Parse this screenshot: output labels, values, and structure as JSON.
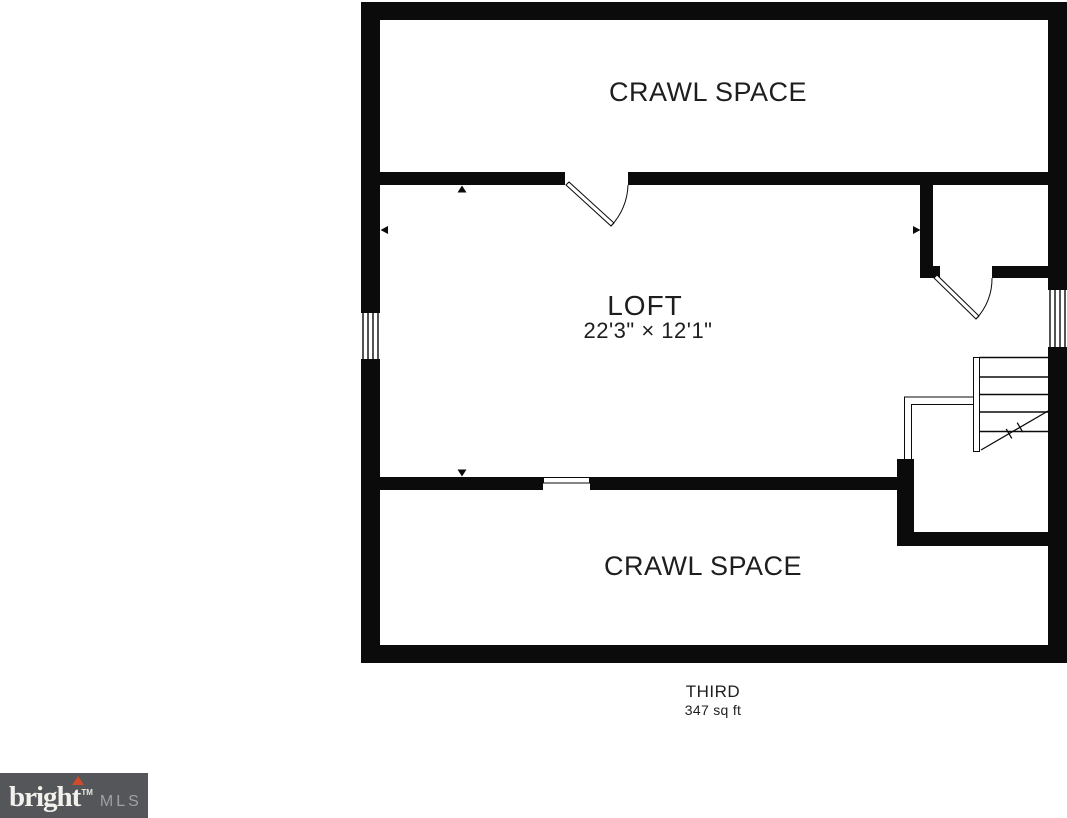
{
  "plan": {
    "rooms": {
      "crawl_space_top": {
        "label": "CRAWL SPACE"
      },
      "loft": {
        "label": "LOFT",
        "dimensions": "22'3\" × 12'1\""
      },
      "crawl_space_bottom": {
        "label": "CRAWL SPACE"
      }
    },
    "floor": {
      "name": "THIRD",
      "area": "347 sq ft"
    },
    "colors": {
      "wall": "#0b0b0b",
      "label_text": "#1e1e1e"
    }
  },
  "logo": {
    "brand": "bright",
    "trademark": "TM",
    "suffix": "MLS",
    "colors": {
      "background": "#55565a",
      "brand_text": "#f2f1ec",
      "suffix_text": "#9fa1a4",
      "accent": "#cf4b2b"
    }
  }
}
